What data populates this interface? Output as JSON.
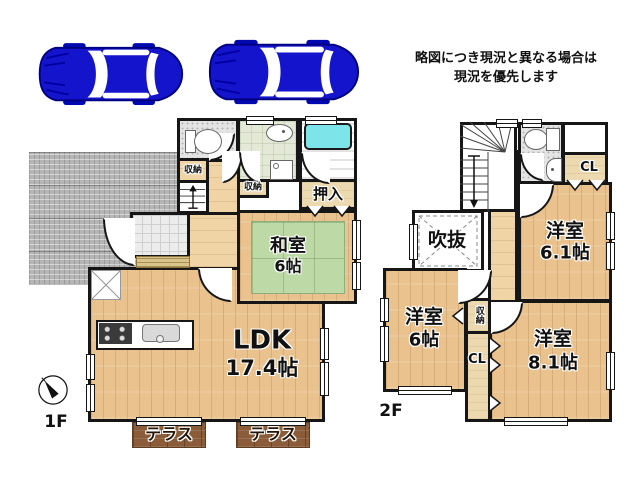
{
  "notice": {
    "line1": "略図につき現況と異なる場合は",
    "line2": "現況を優先します"
  },
  "f1": {
    "label": "1F",
    "ldk": "LDK",
    "ldk_size": "17.4帖",
    "washitsu": "和室",
    "washitsu_size": "6帖",
    "oshiire": "押入",
    "storage_top": "収納",
    "storage_mid": "収納",
    "terrace_left": "テラス",
    "terrace_right": "テラス"
  },
  "f2": {
    "label": "2F",
    "room61": "洋室",
    "room61_size": "6.1帖",
    "room6": "洋室",
    "room6_size": "6帖",
    "room81": "洋室",
    "room81_size": "8.1帖",
    "void": "吹抜",
    "closet_top": "CL",
    "closet_mid": "CL",
    "storage": "収納"
  },
  "colors": {
    "car": "#1414cc",
    "wood_floor": "#e9c28d",
    "tatami": "#bcd9a6",
    "bathtub": "#7de4ea",
    "terrace": "#8a5c3a",
    "wall": "#161616"
  }
}
